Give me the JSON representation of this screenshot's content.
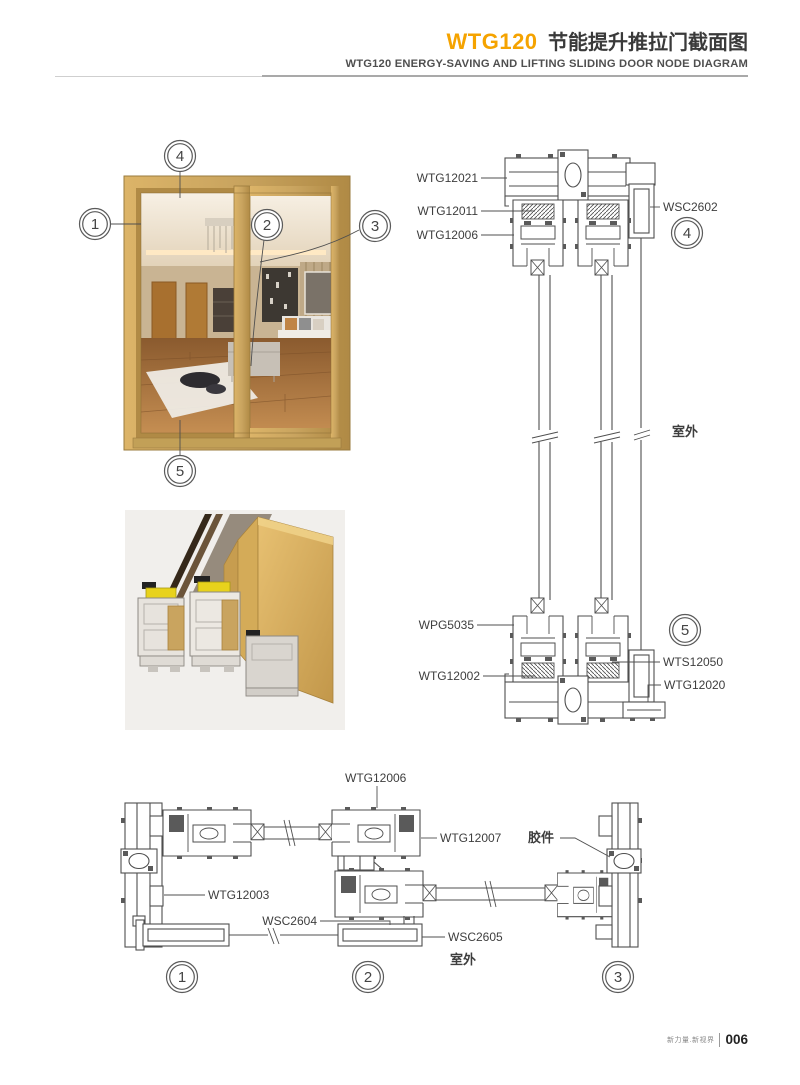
{
  "header": {
    "title_code": "WTG120",
    "title_cn": "节能提升推拉门截面图",
    "subtitle": "WTG120 ENERGY-SAVING AND LIFTING SLIDING DOOR NODE DIAGRAM"
  },
  "photo_callouts": {
    "c1": "1",
    "c2": "2",
    "c3": "3",
    "c4": "4",
    "c5": "5"
  },
  "vertical_section": {
    "wtg12021": "WTG12021",
    "wtg12011": "WTG12011",
    "wtg12006": "WTG12006",
    "wsc2602": "WSC2602",
    "circle4": "4",
    "outdoor": "室外",
    "wpg5035": "WPG5035",
    "wtg12002": "WTG12002",
    "wts12050": "WTS12050",
    "wtg12020": "WTG12020",
    "circle5": "5"
  },
  "horizontal_section": {
    "wtg12006": "WTG12006",
    "wtg12007": "WTG12007",
    "glue_part": "胶件",
    "wtg12003": "WTG12003",
    "wsc2604": "WSC2604",
    "wsc2605": "WSC2605",
    "outdoor": "室外",
    "circle1": "1",
    "circle2": "2",
    "circle3": "3"
  },
  "footer": {
    "slogan": "新力量.新视界",
    "page_number": "006"
  },
  "colors": {
    "accent_orange": "#F5A300",
    "cad_line": "#4F4F4F",
    "frame_gold": "#C9A45F",
    "rule_gray": "#CFCFCF"
  }
}
